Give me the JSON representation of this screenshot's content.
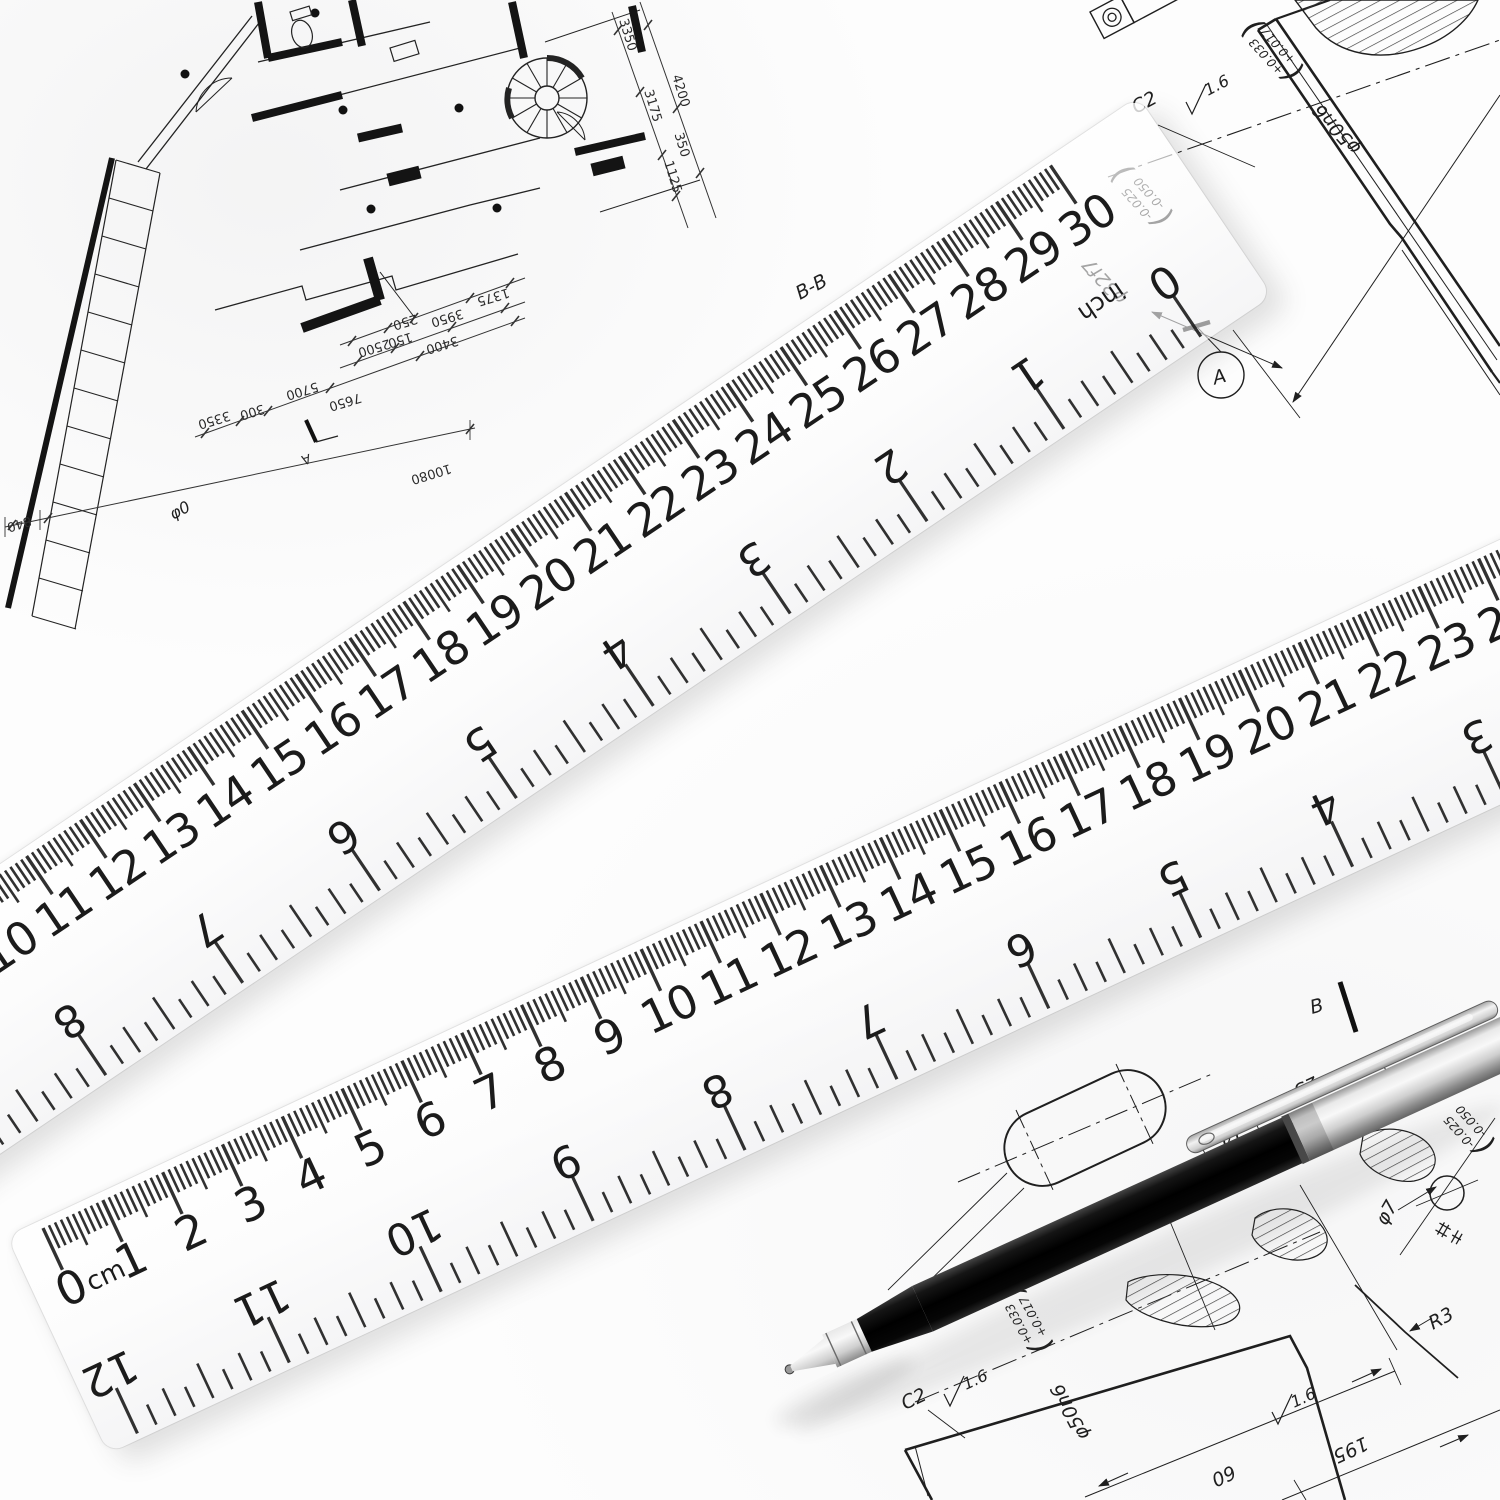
{
  "scene": {
    "description": "Two transparent plastic rulers and a black ballpoint pen lying on architectural and mechanical engineering drawings",
    "paper_color": "#fdfdfd",
    "ink_color": "#1f1f1f",
    "pen_body_color": "#0d0d0d",
    "pen_trim_color": "#d9d9d9"
  },
  "ruler_top": {
    "unit_cm": "cm",
    "unit_inch": "inch",
    "cm_labels": [
      0,
      1,
      2,
      3,
      4,
      5,
      6,
      7,
      8,
      9,
      10,
      11,
      12,
      13,
      14,
      15,
      16,
      17,
      18,
      19,
      20,
      21,
      22,
      23,
      24,
      25,
      26,
      27,
      28,
      29,
      30
    ],
    "inch_labels": [
      0,
      1,
      2,
      3,
      4,
      5,
      6,
      7,
      8,
      9,
      10,
      11,
      12
    ]
  },
  "ruler_bottom": {
    "unit_cm": "cm",
    "unit_inch": "inch",
    "cm_labels": [
      0,
      1,
      2,
      3,
      4,
      5,
      6,
      7,
      8,
      9,
      10,
      11,
      12,
      13,
      14,
      15,
      16,
      17,
      18,
      19,
      20,
      21,
      22,
      23,
      24,
      25,
      26,
      27,
      28,
      29,
      30
    ],
    "inch_labels": [
      0,
      1,
      2,
      3,
      4,
      5,
      6,
      7,
      8,
      9,
      10,
      11,
      12
    ]
  },
  "floor_plan": {
    "section_marker": "A",
    "chain_upper": [
      "250",
      "3950",
      "1375"
    ],
    "chain_lower": [
      "2500",
      "150",
      "3400"
    ],
    "chain_mid": [
      "3350",
      "300",
      "5700",
      "7650"
    ],
    "chain_bottom": [
      "840",
      "10080"
    ],
    "chain_right_outer": [
      "3350",
      "4200"
    ],
    "chain_right_inner": [
      "3175",
      "350",
      "1125"
    ]
  },
  "tr_drawing": {
    "section_title": "B-B",
    "chamfer": "C2",
    "roughness": "1.6",
    "phi50": "φ50n6",
    "phi50_tol_upper": "+0.033",
    "phi50_tol_lower": "+0.017",
    "phi32": "φ32f7",
    "phi32_tol_upper": "-0.025",
    "phi32_tol_lower": "-0.050",
    "datum": "A",
    "fcf_value": "φ0"
  },
  "br_drawing": {
    "chamfer": "C2",
    "roughness_left": "1.6",
    "roughness_right": "1.6",
    "phi50": "φ50n6",
    "phi50_tol_upper": "+0.033",
    "phi50_tol_lower": "+0.017",
    "dim_60": "60",
    "dim_195": "195",
    "dim_14": "14",
    "dim_23": "23",
    "phi7": "φ7",
    "r3": "R3",
    "section_marker": "B",
    "edge_tol_upper": "-0.025",
    "edge_tol_lower": "-0.050"
  },
  "glyphs": {
    "paren_open": "(",
    "paren_close": ")"
  }
}
